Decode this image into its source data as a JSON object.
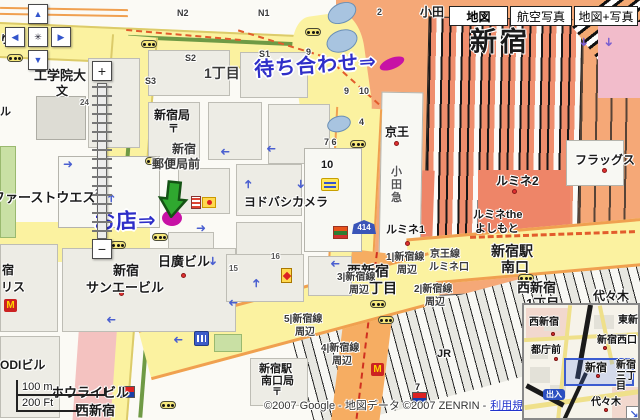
{
  "header": {
    "buttons": [
      {
        "label": "地図",
        "selected": true
      },
      {
        "label": "航空写真",
        "selected": false
      },
      {
        "label": "地図+写真",
        "selected": false
      }
    ]
  },
  "controls": {
    "pan_up": "▲",
    "pan_left": "◀",
    "pan_right": "▶",
    "pan_down": "▼",
    "pan_center": "✳",
    "zoom_in": "+",
    "zoom_out": "−"
  },
  "annotations": {
    "meeting_text": "待ち合わせ⇒",
    "shop_text": "お店⇒"
  },
  "icons": {
    "one_way_arrow": "➜",
    "mcdonalds_m": "M",
    "collapse_arrow": "↘",
    "route_shield": "414"
  },
  "scale": {
    "metric": "100 m",
    "imperial": "200 Ft"
  },
  "attribution": {
    "text": "©2007 Google - 地図データ ©2007 ZENRIN -",
    "link": "利用規約"
  },
  "labels": [
    {
      "text": "工学院大"
    },
    {
      "text": "文"
    },
    {
      "text": "24"
    },
    {
      "text": "新宿局"
    },
    {
      "text": "〒"
    },
    {
      "text": "新宿"
    },
    {
      "text": "郵便局前"
    },
    {
      "text": "ヨドバシカメラ"
    },
    {
      "text": "1丁目"
    },
    {
      "text": "N2"
    },
    {
      "text": "N1"
    },
    {
      "text": "S2"
    },
    {
      "text": "S1"
    },
    {
      "text": "S3"
    },
    {
      "text": "9"
    },
    {
      "text": "9"
    },
    {
      "text": "10"
    },
    {
      "text": "2"
    },
    {
      "text": "4"
    },
    {
      "text": "7 6"
    },
    {
      "text": "10"
    },
    {
      "text": "京王"
    },
    {
      "text": "小田急"
    },
    {
      "text": "新宿"
    },
    {
      "text": "小田"
    },
    {
      "text": "フラッグス"
    },
    {
      "text": "ルミネ2"
    },
    {
      "text": "ルミネthe"
    },
    {
      "text": "よしもと"
    },
    {
      "text": "ルミネ1"
    },
    {
      "text": "新宿駅"
    },
    {
      "text": "南口"
    },
    {
      "text": "京王線"
    },
    {
      "text": "ルミネ口"
    },
    {
      "text": "西新宿"
    },
    {
      "text": "一丁目"
    },
    {
      "text": "西新宿"
    },
    {
      "text": "1丁目"
    },
    {
      "text": "1|新宿線"
    },
    {
      "text": "周辺"
    },
    {
      "text": "2|新宿線"
    },
    {
      "text": "周辺"
    },
    {
      "text": "3|新宿線"
    },
    {
      "text": "周辺"
    },
    {
      "text": "5|新宿線"
    },
    {
      "text": "周辺"
    },
    {
      "text": "4|新宿線"
    },
    {
      "text": "周辺"
    },
    {
      "text": "新宿"
    },
    {
      "text": "サンエービル"
    },
    {
      "text": "日廣ビル"
    },
    {
      "text": "15"
    },
    {
      "text": "16"
    },
    {
      "text": "23"
    },
    {
      "text": "ファーストウエスト"
    },
    {
      "text": "宿"
    },
    {
      "text": "リス"
    },
    {
      "text": "り東"
    },
    {
      "text": "ル"
    },
    {
      "text": "ODIビル"
    },
    {
      "text": "ホウライビル"
    },
    {
      "text": "西新宿"
    },
    {
      "text": "新宿駅"
    },
    {
      "text": "南口局"
    },
    {
      "text": "〒"
    },
    {
      "text": "JR"
    },
    {
      "text": "7"
    },
    {
      "text": "代々木"
    }
  ],
  "inset": {
    "labels": [
      {
        "text": "西新宿"
      },
      {
        "text": "東新宿"
      },
      {
        "text": "新宿西口"
      },
      {
        "text": "都庁前"
      },
      {
        "text": "新宿"
      },
      {
        "text": "新宿三丁目"
      },
      {
        "text": "代々木"
      }
    ],
    "badge": "出入"
  },
  "colors": {
    "road_major": "#FBF2A0",
    "road_national": "#F6AD62",
    "station_area": "#F5A877",
    "station_building": "#EE8568",
    "annotation_blue": "#2E2EC8",
    "marker_magenta": "#C712A5",
    "water_blue": "#A8C4E0",
    "link_blue": "#2233CC",
    "one_way_blue": "#4A5FD0",
    "boundary_orange": "#E25C2C"
  }
}
